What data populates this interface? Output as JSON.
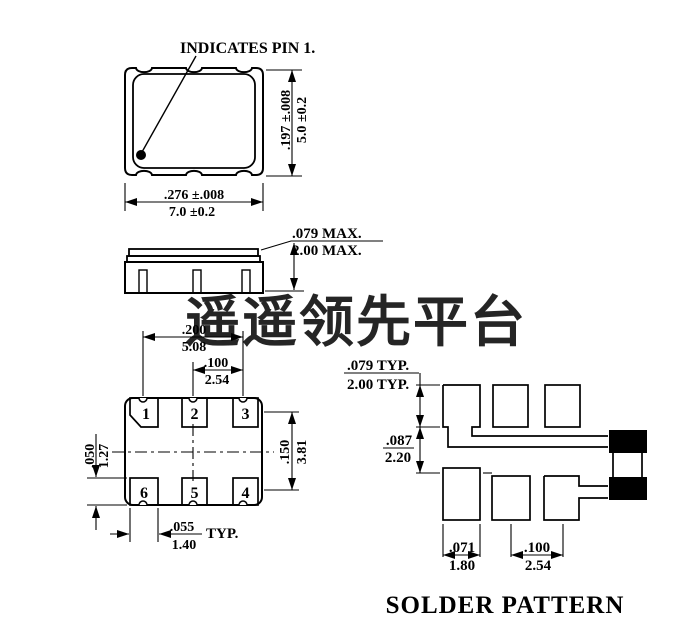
{
  "top_view": {
    "pin1_label": "INDICATES PIN 1.",
    "height": {
      "inch": ".197 ±.008",
      "mm": "5.0 ±0.2"
    },
    "width": {
      "inch": ".276 ±.008",
      "mm": "7.0 ±0.2"
    }
  },
  "side_view": {
    "height": {
      "inch": ".079 MAX.",
      "mm": "2.00 MAX."
    }
  },
  "watermark": {
    "text": "遥遥领先平台",
    "color": "#f0bc95"
  },
  "bottom_view": {
    "pins": [
      "1",
      "2",
      "3",
      "6",
      "5",
      "4"
    ],
    "pad_span": {
      "inch": ".200",
      "mm": "5.08"
    },
    "pad_pitch": {
      "inch": ".100",
      "mm": "2.54"
    },
    "row_pitch": {
      "inch": ".150",
      "mm": "3.81"
    },
    "pad_height": {
      "inch": ".050",
      "mm": "1.27"
    },
    "pad_width": {
      "inch": ".055",
      "mm": "1.40",
      "suffix": "TYP."
    }
  },
  "solder_pattern": {
    "title": "SOLDER PATTERN",
    "pad_height": {
      "inch": ".079 TYP.",
      "mm": "2.00 TYP."
    },
    "row_gap": {
      "inch": ".087",
      "mm": "2.20"
    },
    "pad_width": {
      "inch": ".071",
      "mm": "1.80"
    },
    "pad_pitch": {
      "inch": ".100",
      "mm": "2.54"
    }
  }
}
